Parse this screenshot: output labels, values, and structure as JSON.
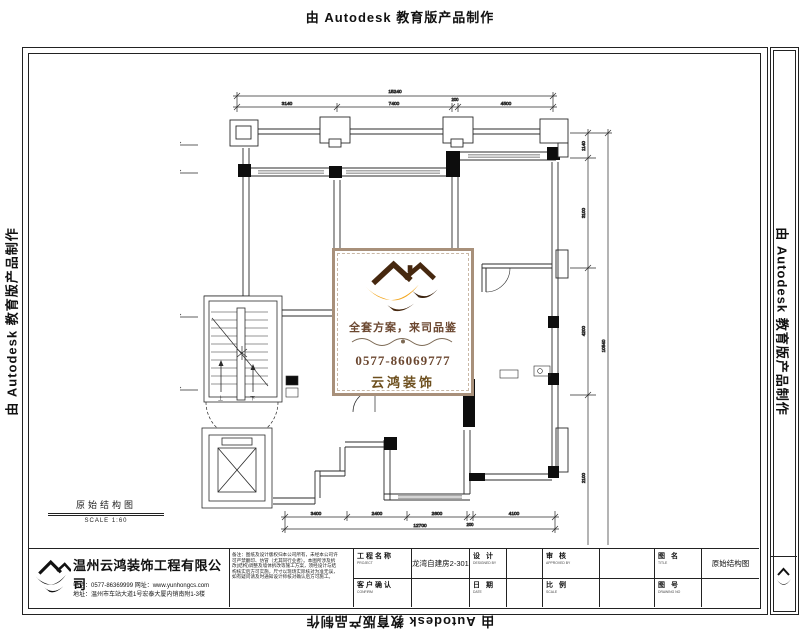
{
  "stamp": {
    "text": "由 Autodesk 教育版产品制作"
  },
  "plan": {
    "title": "原始结构图",
    "scale": "SCALE 1:60",
    "stair": {
      "up": "上",
      "down": "下"
    },
    "dims": {
      "top_total": "15240",
      "top_segments": [
        "3140",
        "7400",
        "200",
        "4500"
      ],
      "bottom_segments": [
        "3400",
        "2400",
        "2600",
        "200",
        "4100"
      ],
      "bottom_total": "12700",
      "left_segments": [
        "1900",
        "4700",
        "2300"
      ],
      "right_segments": [
        "1140",
        "3100",
        "4200",
        "2100"
      ],
      "right_total": "10540"
    }
  },
  "watermark_card": {
    "slogan": "全套方案，来司品鉴",
    "phone": "0577-86069777",
    "brand": "云鸿装饰",
    "colors": {
      "orange": "#F2A51C",
      "brown": "#46280F",
      "text_brown": "#6B4730"
    }
  },
  "title_block": {
    "company": {
      "name": "温州云鸿装饰工程有限公司",
      "contact_line1": "电话：0577-86369999  网址：www.yunhongcs.com",
      "contact_line2": "地址：温州市车站大道1号宏泰大厦内销南附1-3楼"
    },
    "notes_line1": "备注：图纸及设计版权归本公司所有，未经本公司许",
    "notes_line2": "可严禁翻印、仿冒（尤其同行业者）。本图所涉及拆",
    "notes_line3": "改(结构)调整及墙体拆改等施工方案，须经设计与结",
    "notes_line4": "构核实后方可实施，尺寸以现场实际核对为准无误，",
    "notes_line5": "如有疑问请及时通知设计师核对确认后方可施工。",
    "fields": {
      "project": {
        "label": "工程名称",
        "sub": "PROJECT",
        "value": "龙湾自建房2-301"
      },
      "confirm": {
        "label": "客户确认",
        "sub": "CONFIRM",
        "value": ""
      },
      "designer": {
        "label": "设 计",
        "sub": "DESIGNED BY",
        "value": ""
      },
      "date": {
        "label": "日 期",
        "sub": "DATE",
        "value": ""
      },
      "approver": {
        "label": "审 核",
        "sub": "APPROVED BY",
        "value": ""
      },
      "ratio": {
        "label": "比 例",
        "sub": "SCALE",
        "value": ""
      },
      "drawing_name": {
        "label": "图 名",
        "sub": "TITLE",
        "value": "原始结构图"
      },
      "drawing_no": {
        "label": "图 号",
        "sub": "DRAWING NO",
        "value": ""
      }
    }
  }
}
